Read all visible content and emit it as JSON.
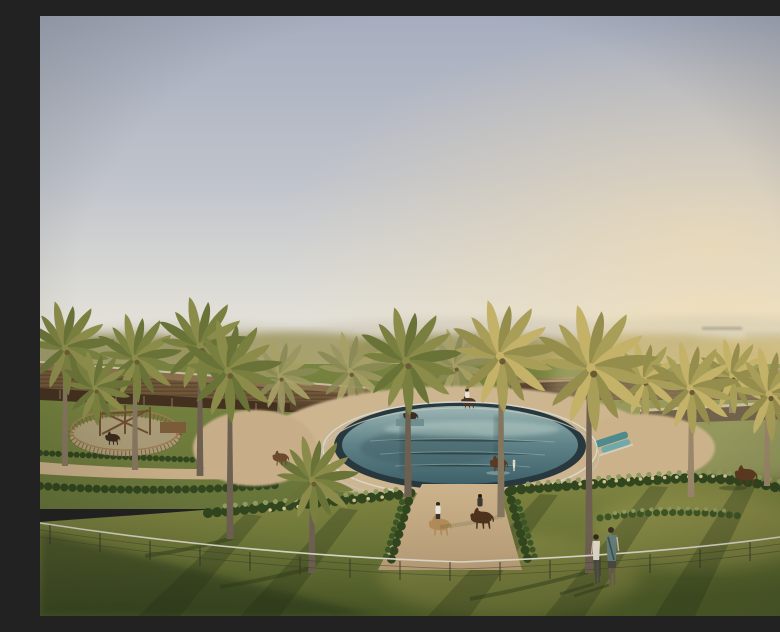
{
  "scene": {
    "title": "Equestrian resort at golden hour",
    "description": "Aerial golden-hour rendering of an equestrian resort: an oval horse swimming pool ringed by white rails and tall date palms, manicured lawns, hedge rows and sandy riding paths, low timber stable pavilions, horses with riders and grooms, a lunging pen on the left, and two visitors watching from behind a thin wire fence in the foreground.",
    "time_of_day": "golden hour",
    "sky": "hazy pale blue fading to warm cream at the horizon"
  },
  "palette": {
    "sky_top": "#a6adbe",
    "sky_horizon": "#ece8dd",
    "sun_glow": "#f5ddae",
    "distant_hills": "#c5bfae",
    "villa_white": "#cfcabd",
    "building_wood": "#6f5639",
    "building_dark": "#4a3523",
    "palm_leaf": "#79803f",
    "palm_leaf_lit": "#c3b268",
    "palm_trunk": "#84755f",
    "lawn_lit": "#8f9149",
    "lawn_mid": "#6f7c3c",
    "lawn_shadow": "#3c4a22",
    "hedge_green": "#31451f",
    "sand_path": "#cdb590",
    "pool_rim": "#27393e",
    "water_light": "#9db6b4",
    "water_deep": "#3f6069",
    "rail_white": "#d8dbd3",
    "horse_brown": "#5a3a24",
    "horse_white": "#d9d2c0",
    "shirt_white": "#ded9cb",
    "shirt_teal": "#647f7c"
  },
  "inventory": {
    "pool": {
      "shape": "oval",
      "type": "equine swimming pool",
      "rail_rings": 2
    },
    "horses_total": 9,
    "horses_in_or_at_pool": 3,
    "riders": 3,
    "grooms": 2,
    "walkers_on_left_path": 3,
    "visitors_at_fence": 2,
    "foreground_palms": 8,
    "structures": [
      "left timber stable pavilion",
      "right stable band",
      "lunging pen",
      "distant white villas"
    ],
    "foreground": [
      "curved wire fence",
      "long evening shadows on lawn"
    ]
  }
}
